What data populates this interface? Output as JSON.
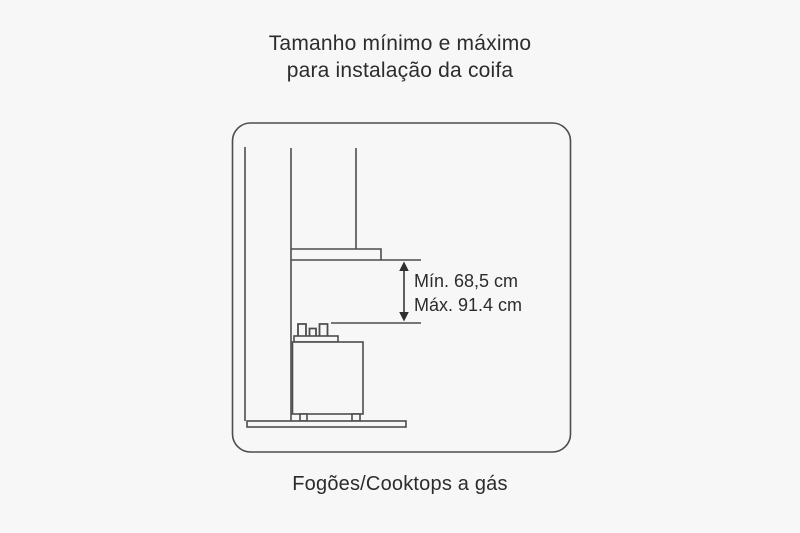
{
  "page": {
    "background_color": "#f7f7f7",
    "line_color": "#4d4d4d",
    "text_color": "#2c2c2c"
  },
  "title": {
    "line1": "Tamanho mínimo e máximo",
    "line2": "para instalação da coifa"
  },
  "diagram": {
    "description": "Side-view line drawing of a range hood (coifa) with chimney installed on a wall above a gas cooktop, showing the allowed vertical distance between hood bottom and cooktop burners",
    "elements": [
      "wall",
      "chimney-duct",
      "hood",
      "gas-cooktop",
      "floor",
      "distance-arrow"
    ],
    "measurements": {
      "min_label": "Mín. 68,5 cm",
      "max_label": "Máx. 91.4 cm"
    }
  },
  "caption": "Fogões/Cooktops a gás"
}
